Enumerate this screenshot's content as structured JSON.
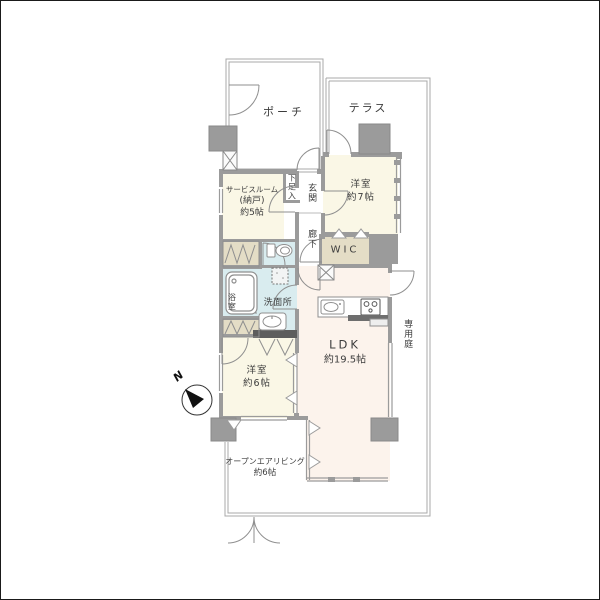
{
  "floorplan": {
    "type": "japanese-apartment-floorplan",
    "compass": {
      "label": "N",
      "north_direction": "upper-left"
    },
    "rooms": {
      "porch": {
        "label": "ポーチ"
      },
      "terrace": {
        "label": "テラス"
      },
      "service_room": {
        "line1": "サービスルーム",
        "line2": "(納戸)",
        "line3": "約5帖"
      },
      "shoe_box": {
        "label": "下足入"
      },
      "entrance": {
        "label": "玄関"
      },
      "hallway": {
        "label": "廊下"
      },
      "western_room_7": {
        "line1": "洋室",
        "line2": "約7帖"
      },
      "wic": {
        "label": "WIC"
      },
      "bathroom": {
        "label": "浴室"
      },
      "washroom": {
        "label": "洗面所"
      },
      "western_room_6": {
        "line1": "洋室",
        "line2": "約6帖"
      },
      "ldk": {
        "line1": "LDK",
        "line2": "約19.5帖"
      },
      "private_garden": {
        "label": "専用庭"
      },
      "open_air_living": {
        "line1": "オープンエアリビング",
        "line2": "約6帖"
      }
    },
    "colors": {
      "wall_gray": "#9b9b9b",
      "room_cream": "#faf7e6",
      "closet_beige": "#e4ddc6",
      "wet_area_blue": "#d9ecef",
      "ldk_pink": "#fcf3ec",
      "dark_counter": "#6e6e6e",
      "outline": "#9f9f9f",
      "text": "#3c3c3c"
    }
  }
}
